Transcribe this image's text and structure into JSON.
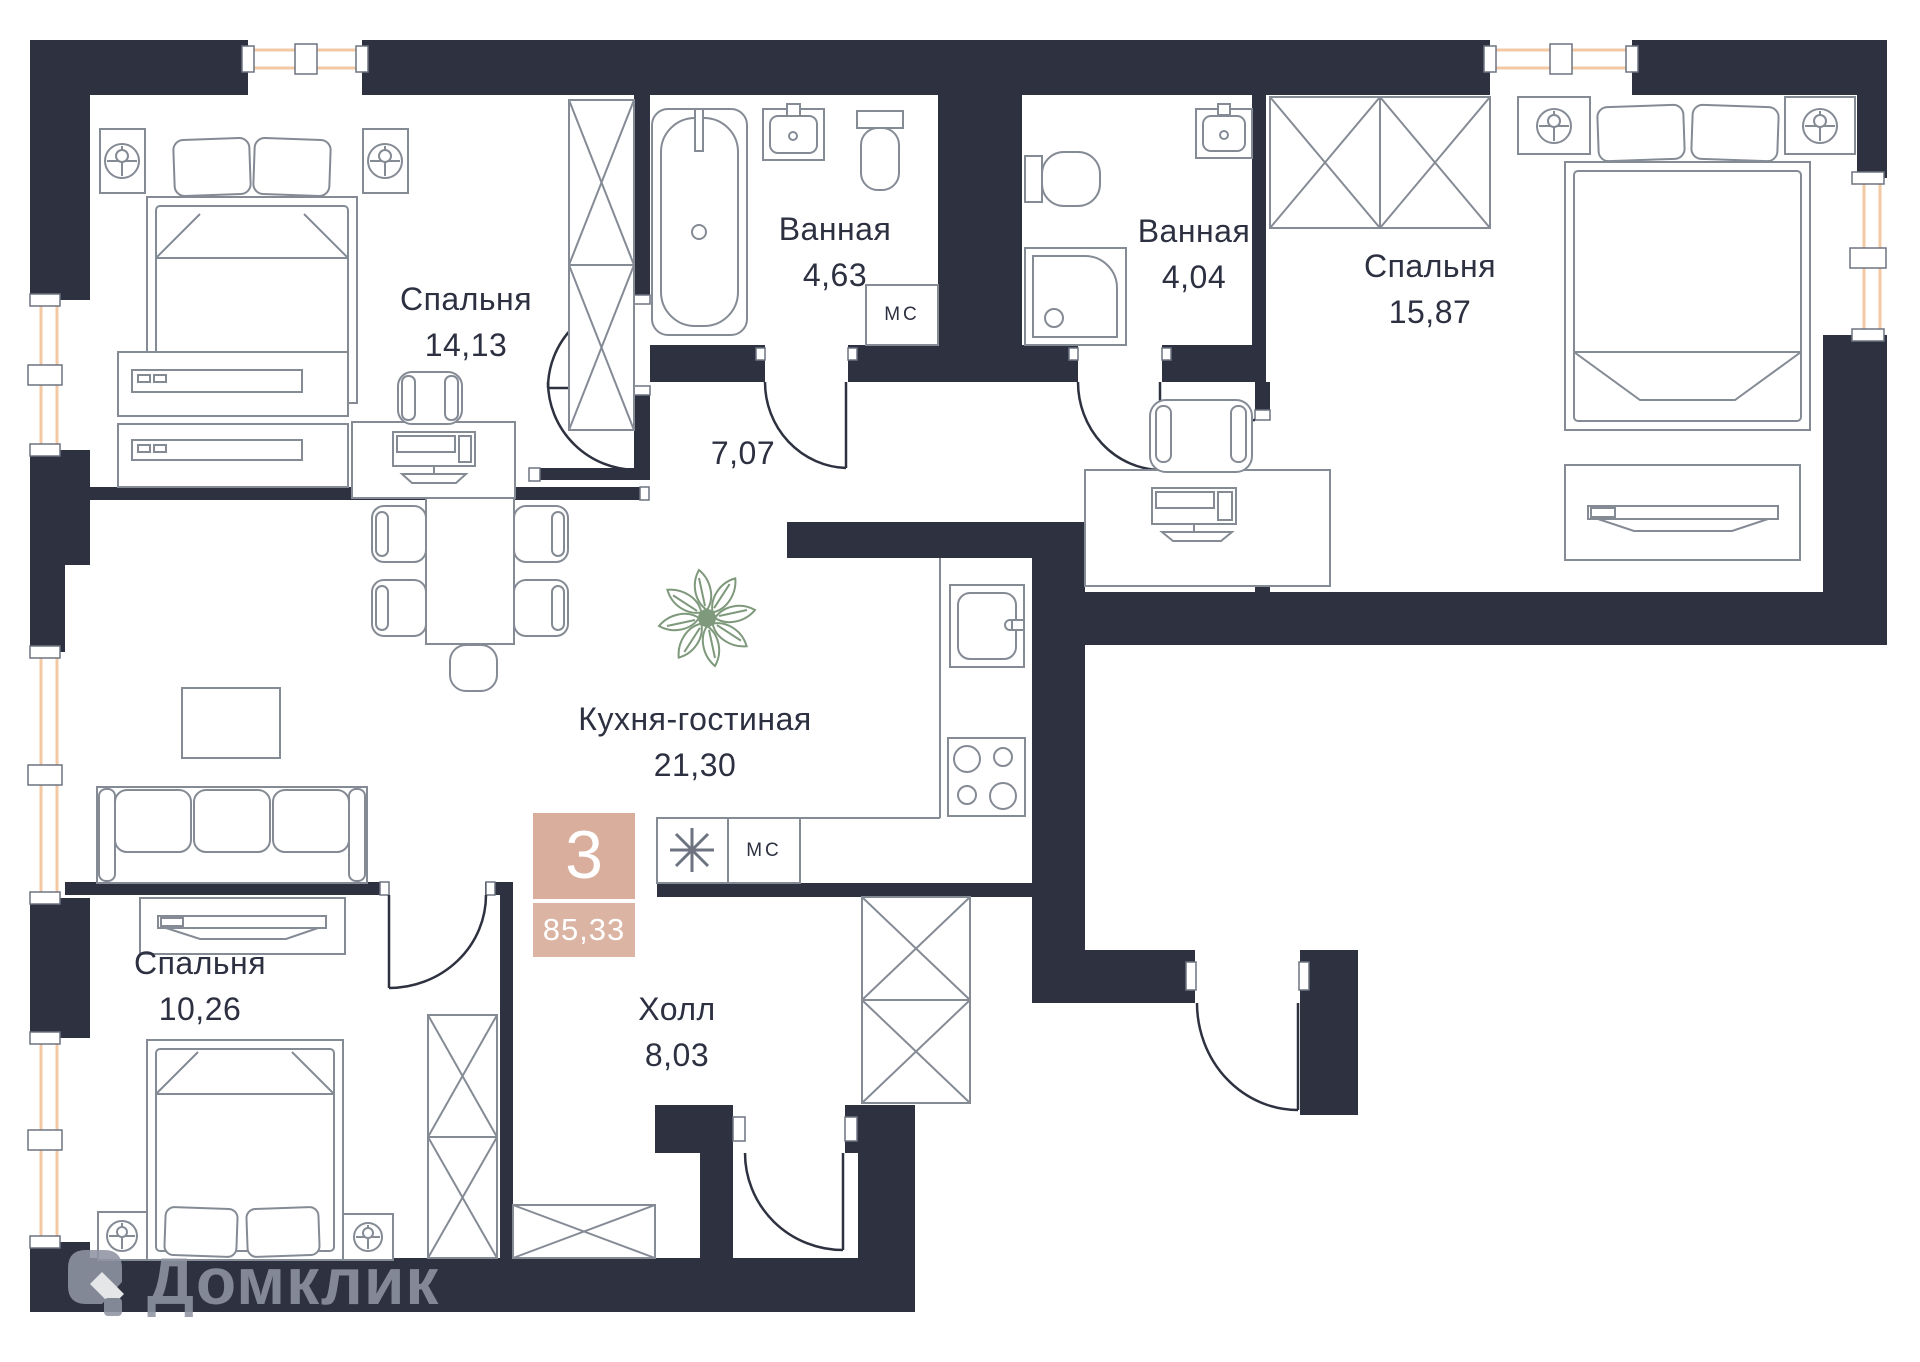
{
  "watermark": {
    "text": "Домклик"
  },
  "badge": {
    "rooms_count": "3",
    "total_area": "85,33"
  },
  "rooms": [
    {
      "id": "bedroom-1",
      "label": "Спальня",
      "area": "14,13"
    },
    {
      "id": "bathroom-1",
      "label": "Ванная",
      "area": "4,63"
    },
    {
      "id": "bathroom-2",
      "label": "Ванная",
      "area": "4,04"
    },
    {
      "id": "bedroom-2",
      "label": "Спальня",
      "area": "15,87"
    },
    {
      "id": "corridor",
      "label": "",
      "area": "7,07"
    },
    {
      "id": "kitchen-living",
      "label": "Кухня-гостиная",
      "area": "21,30"
    },
    {
      "id": "bedroom-3",
      "label": "Спальня",
      "area": "10,26"
    },
    {
      "id": "hall",
      "label": "Холл",
      "area": "8,03"
    }
  ],
  "markers": {
    "washing_machine": "МС"
  },
  "colors": {
    "wall": "#2d3140",
    "window": "#f2c9a2",
    "badge": "#d9ae9c",
    "furniture_stroke": "#858b95",
    "plant": "#7e997b",
    "watermark": "#8f95a2",
    "text": "#2c3040"
  }
}
